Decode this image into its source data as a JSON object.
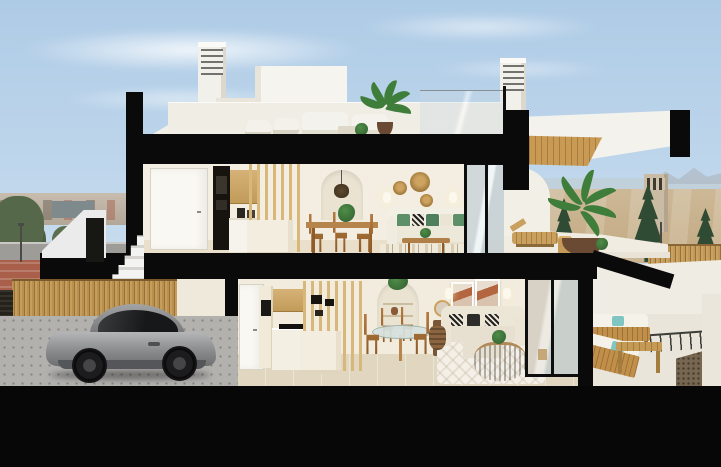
{
  "scene": {
    "type": "architectural-cross-section-render",
    "description": "Cutaway 3D rendering of a two-storey white coastal townhouse shown in section: a rooftop solarium with two louvered chimneys, stair bulkhead and lounge furniture; an upper floor with hallway door, wood-and-white kitchen, slatted timber screen, arched niche with pendant lamp, dining set, white sofa with green cushions and a sliding glass door onto a terrace with sun lounger and potted palm under a cantilevered roof with timber soffit; a ground floor with kitchen, round glass dining table, beige sofa, rattan coffee table and sliding glass door onto a furnished terrace with timber sofas, teal cushions and a gravel bed; and a street-level garage forecourt with a grey sports coupe in front of a timber slat fence. A hazy city skyline with trees sits to the left, and a dirt field with conifers, a watchtower, the sea and distant mountains to the right. Thick black bands mark the cut walls and floor slabs.",
    "floors_visible": 3,
    "style": "white minimalist architecture with black section cuts and warm wood accents",
    "text_visible": "none"
  },
  "palette": {
    "sky-top": "#aecbe6",
    "sky-mid": "#c7dcee",
    "sky-horizon": "#e6eef5",
    "cut-black": "#0a0a0a",
    "foundation-black": "#070707",
    "wall-cream": "#f3eee1",
    "wall-white": "#f2efe7",
    "wood-soffit": "#c89a54",
    "slat-wood": "#d8b87a",
    "fence-wood": "#c08f4a",
    "floor-tile": "#e1d7c1",
    "garage-floor": "#b2b1ae",
    "car-grey": "#8a8b8d",
    "plant-green": "#3f7d3b",
    "plant-dark": "#2f4b34",
    "teal": "#7fc6c2",
    "terracotta": "#b3663f",
    "sea-blue": "#c0d1dc",
    "field-tan": "#cdb897",
    "gravel-brown": "#776751",
    "city-tan": "#c7bcae"
  },
  "objects": {
    "background_left": [
      "city-skyline",
      "street-trees",
      "road",
      "red-sidewalk",
      "street-lamp"
    ],
    "background_right": [
      "sea-horizon",
      "mountains",
      "dirt-field",
      "watchtower",
      "conifer-trees",
      "street-lamps",
      "timber-fence"
    ],
    "rooftop": [
      "chimney-vents",
      "stair-bulkhead",
      "sun-loungers",
      "outdoor-sofas",
      "low-table",
      "potted-palm",
      "glass-balustrade"
    ],
    "upper_floor": [
      "hall-door",
      "oven-column",
      "kitchen-cabinets",
      "kitchen-island",
      "timber-slat-screen",
      "arched-niche-pendant",
      "dining-table-chairs",
      "wall-baskets",
      "wall-sconces",
      "white-sofa-green-cushions",
      "coffee-table",
      "striped-rug",
      "sliding-glass-door"
    ],
    "upper_terrace": [
      "curved-privacy-wall",
      "sun-lounger",
      "side-table",
      "potted-palm",
      "cantilever-roof-timber-soffit"
    ],
    "ground_floor": [
      "hall-door",
      "tall-oven-cabinet",
      "kitchen-cabinets",
      "cooktop",
      "timber-slat-screen",
      "kitchen-island",
      "arched-shelf-niche",
      "round-glass-dining-table",
      "timber-chairs",
      "console-mirror",
      "framed-artworks",
      "wall-sconces",
      "beige-sofa-patterned-pillows",
      "rattan-coffee-table",
      "white-rug",
      "storage-basket",
      "sliding-glass-door"
    ],
    "lower_terrace": [
      "timber-sofa-set",
      "teal-cushions",
      "timber-coffee-table",
      "thin-railing",
      "gravel-bed",
      "parapet-walls"
    ],
    "garage": [
      "timber-slat-fence",
      "dark-hedge",
      "paved-driveway",
      "grey-sports-car"
    ],
    "entrance": [
      "parapet-wall",
      "dark-doorway",
      "exterior-stairs"
    ]
  }
}
